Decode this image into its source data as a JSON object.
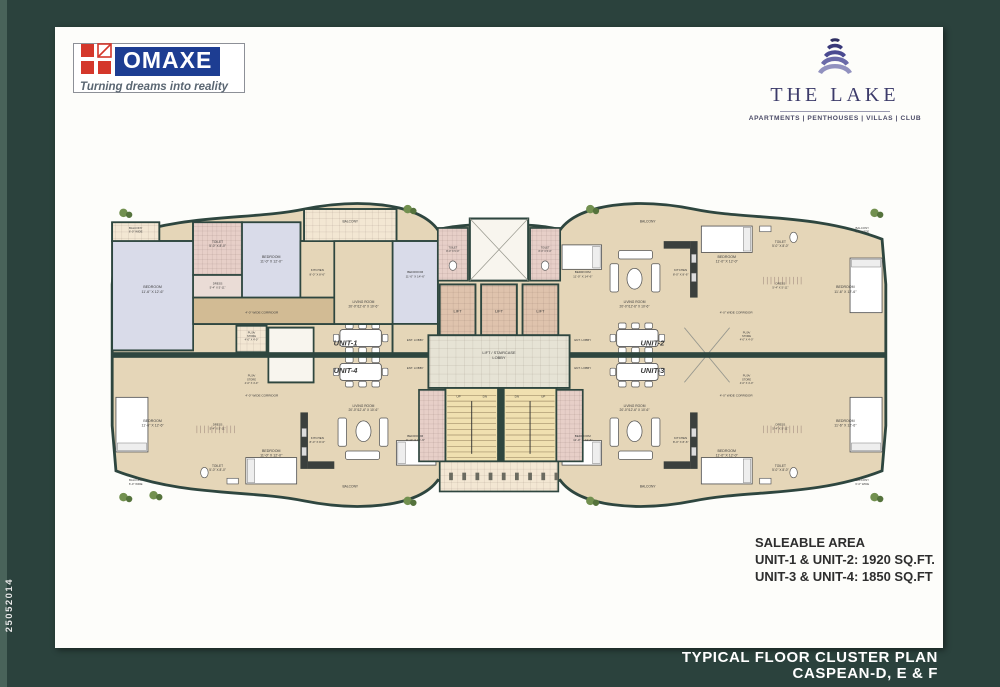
{
  "side_code": "25052014",
  "footer": {
    "line1": "TYPICAL FLOOR CLUSTER PLAN",
    "line2": "CASPEAN-D, E & F"
  },
  "logos": {
    "omaxe": {
      "name": "OMAXE",
      "tagline": "Turning dreams into reality",
      "brand_blue": "#1d3d92",
      "brand_red": "#d4372b"
    },
    "lake": {
      "name": "THE LAKE",
      "tagline": "APARTMENTS | PENTHOUSES | VILLAS | CLUB",
      "navy": "#3c3b6a"
    }
  },
  "saleable": {
    "heading": "SALEABLE AREA",
    "unit12": "UNIT-1 & UNIT-2: 1920 SQ.FT.",
    "unit34": "UNIT-3 & UNIT-4: 1850 SQ.FT"
  },
  "plan": {
    "units": {
      "u1": "UNIT-1",
      "u2": "UNIT-2",
      "u3": "UNIT-3",
      "u4": "UNIT-4"
    },
    "rooms": {
      "balcony_side": [
        "BALCONY",
        "6'-0\" WIDE"
      ],
      "bedroom_a": [
        "BEDROOM",
        "11'-6\" X 12'-6\""
      ],
      "bedroom_b": [
        "BEDROOM",
        "11'-0\" X 12'-0\""
      ],
      "bedroom_c": [
        "BEDROOM",
        "11'-0\" X 14'-6\""
      ],
      "toilet": [
        "TOILET",
        "5'-0\" X 8'-0\""
      ],
      "toilet_core": [
        "TOILET",
        "8'-0\" X 5'-0\""
      ],
      "dress": [
        "DRESS",
        "5'-4\" X 5'-11\""
      ],
      "kitchen": [
        "KITCHEN",
        "8'-0\" X 8'-6\""
      ],
      "living": [
        "LIVING ROOM",
        "20'-0\"/12'-6\" X 10'-6\""
      ],
      "corridor": [
        "4'-0\" WIDE CORRIDOR"
      ],
      "balcony": [
        "BALCONY"
      ],
      "puja": [
        "PUJA/",
        "STORE",
        "4'-0\" X 4'-0\""
      ],
      "lift": [
        "LIFT"
      ],
      "lobby": [
        "LIFT / STAIRCASE",
        "LOBBY"
      ],
      "ent_lobby": [
        "ENT. LOBBY"
      ],
      "up": [
        "UP"
      ],
      "dn": [
        "DN"
      ]
    },
    "colors": {
      "wall": "#2e463f",
      "floor_tan": "#e5d6b8",
      "corridor": "#d2bb94",
      "bedroom": "#d9dbe9",
      "toilet": "#e7cfc8",
      "dress": "#eadcd6",
      "balcony": "#f3e7d3",
      "lift": "#dfc3ad",
      "lobby": "#e6e3d5",
      "stairs": "#f0e0b0",
      "shaft": "#f8f5ee",
      "plant": "#72904f",
      "label": "#3a3a3a"
    }
  }
}
